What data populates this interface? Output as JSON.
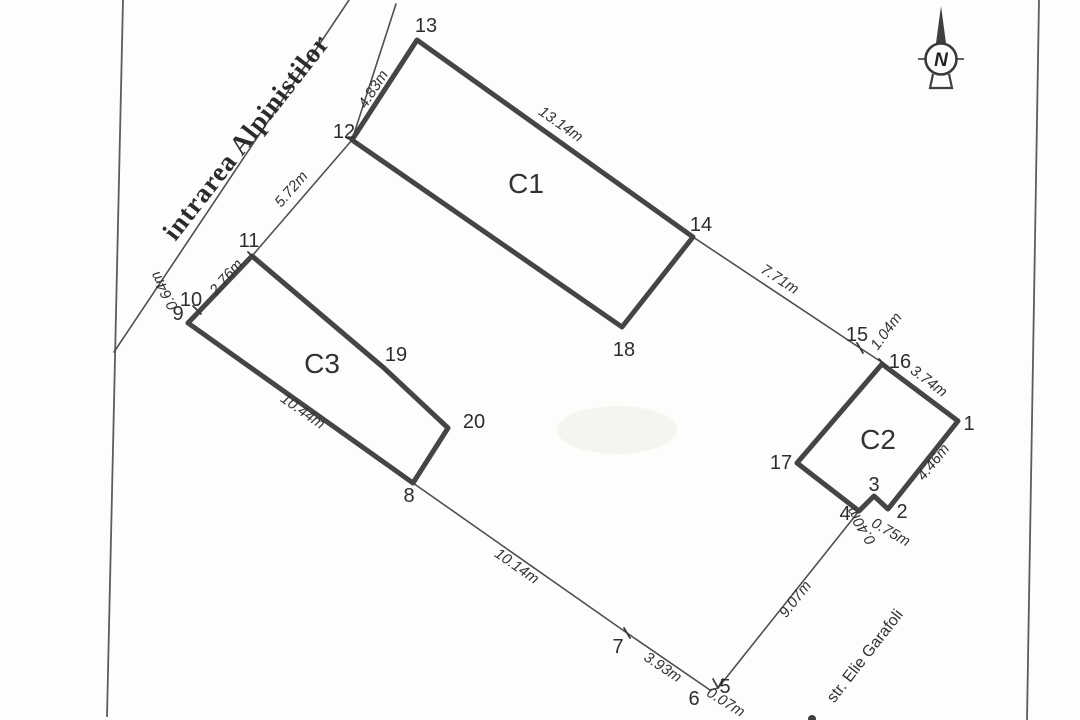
{
  "streets": {
    "alpinistilor": "intrarea Alpinistilor",
    "garafoli": "str. Elie Garafoli"
  },
  "north": {
    "label": "N"
  },
  "buildings": {
    "c1": "C1",
    "c2": "C2",
    "c3": "C3"
  },
  "points": {
    "p1": "1",
    "p2": "2",
    "p3": "3",
    "p4": "4",
    "p5": "5",
    "p6": "6",
    "p7": "7",
    "p8": "8",
    "p9": "9",
    "p10": "10",
    "p11": "11",
    "p12": "12",
    "p13": "13",
    "p14": "14",
    "p15": "15",
    "p16": "16",
    "p17": "17",
    "p18": "18",
    "p19": "19",
    "p20": "20"
  },
  "dimensions": {
    "seg_12_13": "4.83m",
    "seg_13_14": "13.14m",
    "seg_12_11": "5.72m",
    "seg_11_10": "2.76m",
    "seg_10_9": "0.64m",
    "seg_14_15": "7.71m",
    "seg_15_16": "1.04m",
    "seg_16_1": "3.74m",
    "seg_1_2": "4.46m",
    "seg_2_3": "0.75m",
    "seg_3_4": "0.40m",
    "seg_4_5": "9.07m",
    "seg_5_6": "0.07m",
    "seg_6_7": "3.93m",
    "seg_7_8": "10.14m",
    "seg_8_9": "10.44m"
  },
  "colors": {
    "ink": "#454545",
    "paper": "#fdfdfc"
  }
}
